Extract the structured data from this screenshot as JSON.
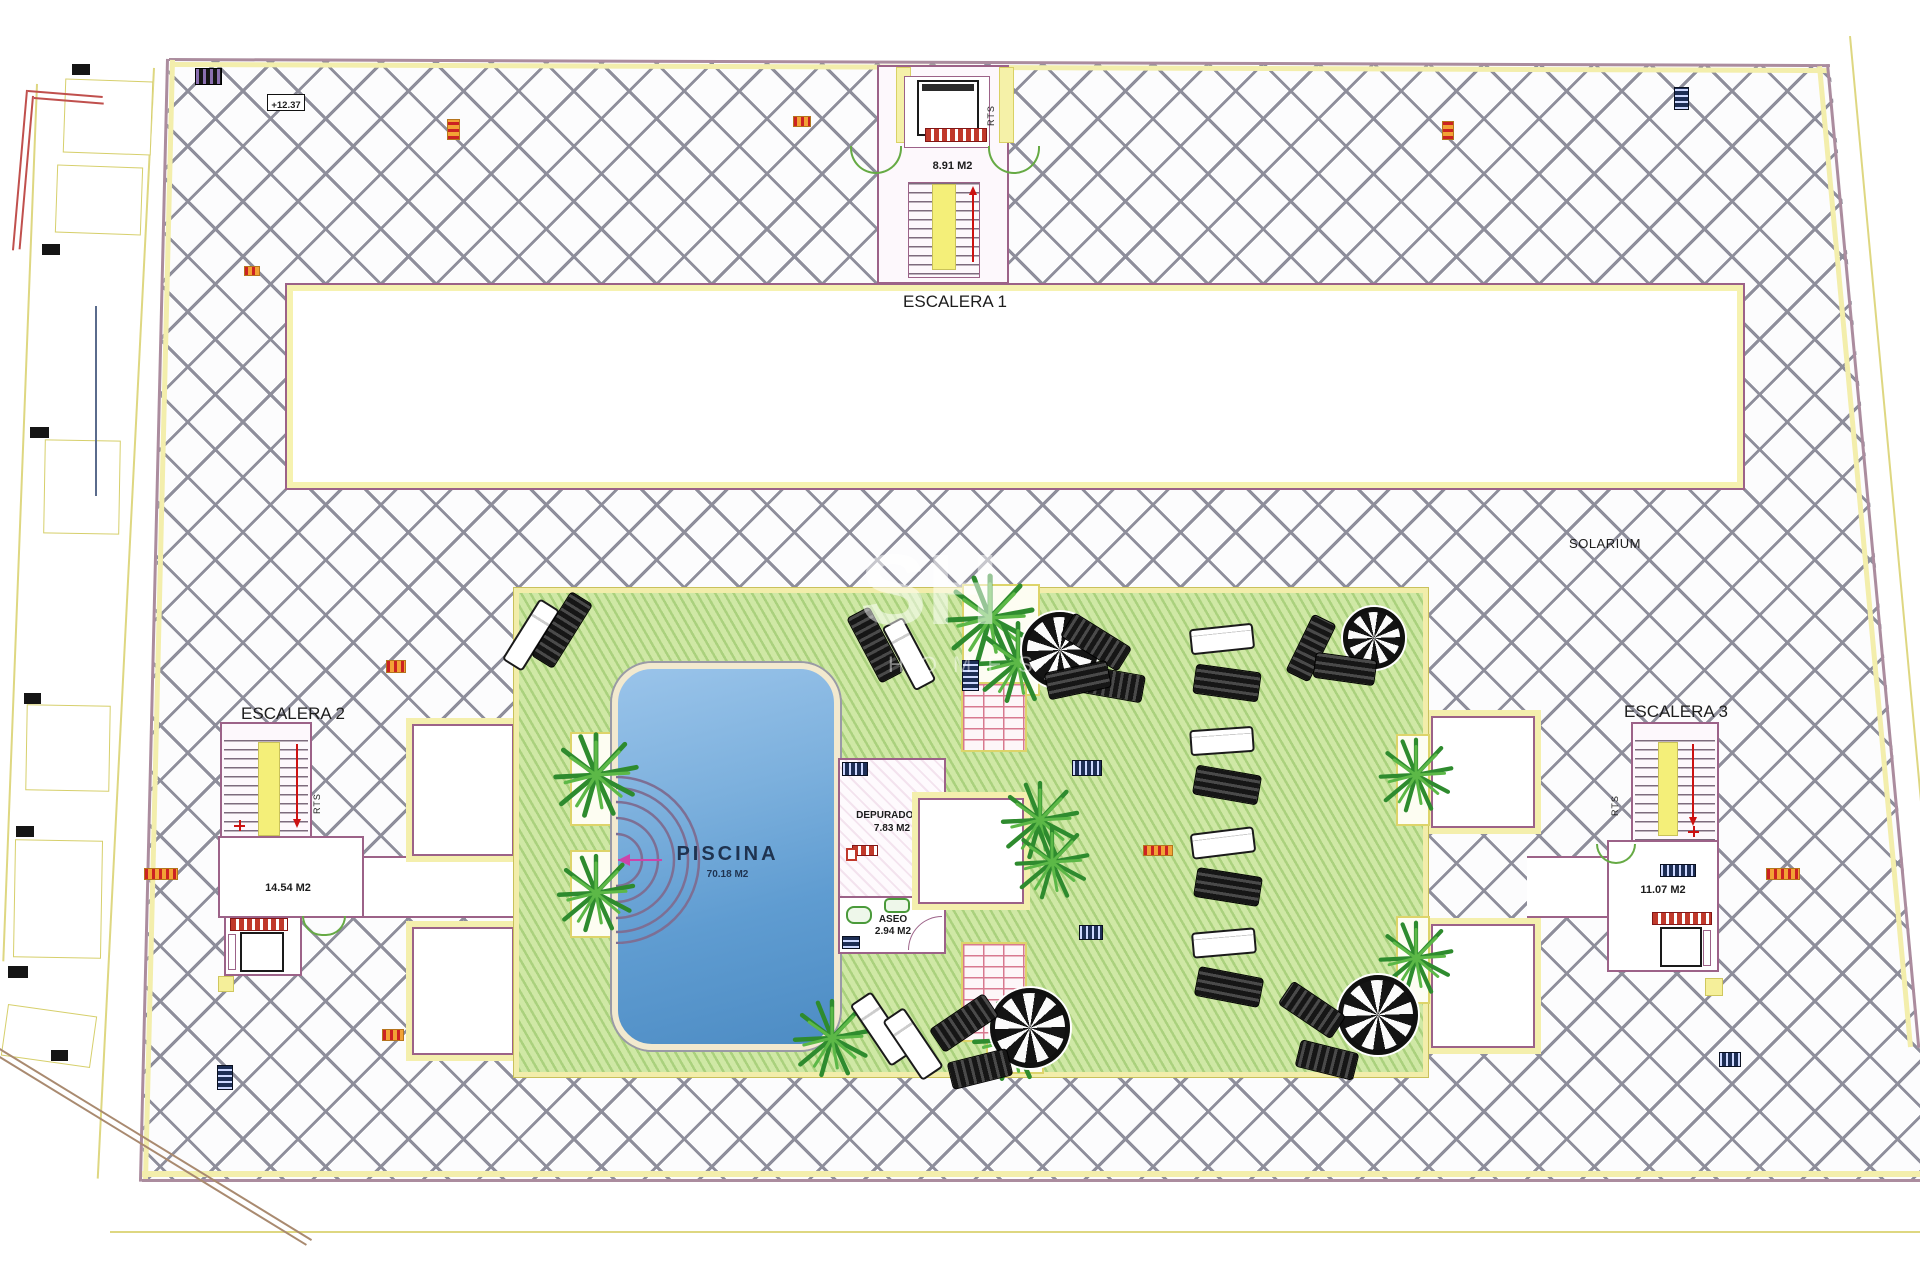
{
  "plan": {
    "solarium_label": "SOLARIUM",
    "elevation_marker": "+12.37",
    "escalera1": {
      "title": "ESCALERA 1",
      "area": "8.91 M2",
      "rts": "RTS"
    },
    "escalera2": {
      "title": "ESCALERA 2",
      "area": "14.54 M2",
      "rts": "RTS"
    },
    "escalera3": {
      "title": "ESCALERA 3",
      "area": "11.07 M2",
      "rts": "RTS"
    },
    "piscina": {
      "title": "PISCINA",
      "area": "70.18 M2"
    },
    "depuradora": {
      "title": "DEPURADORA",
      "area": "7.83 M2"
    },
    "aseo": {
      "title": "ASEO",
      "area": "2.94 M2"
    },
    "watermark": {
      "line1": "SH",
      "line2": "HOMES"
    },
    "colors": {
      "deck_hatch_line": "#8e8e9b",
      "lawn_green": "#cfe8a5",
      "pool_blue": "#5b9bd5",
      "wall_purple": "#9c6288",
      "accent_yellow": "#f2edaa",
      "stair_yellow": "#f4ef79",
      "marker_orange": "#f2a235",
      "marker_navy": "#1d2e55",
      "plant_green": "#2e8b2e",
      "arrow_red": "#cc1111"
    }
  }
}
